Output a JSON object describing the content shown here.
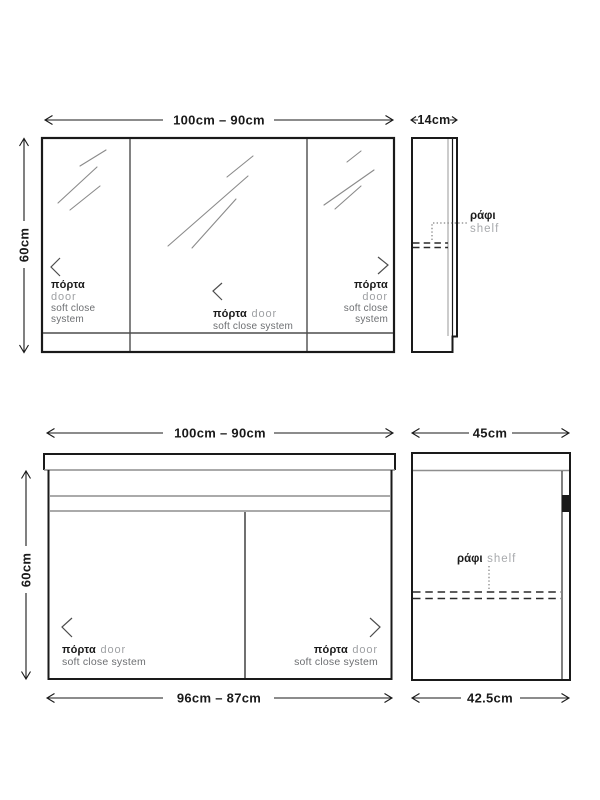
{
  "diagram": {
    "labels": {
      "porta": "πόρτα",
      "door": "door",
      "soft_close": "soft close",
      "system": "system",
      "soft_close_system": "soft close system",
      "rafi": "ράφι",
      "shelf": "shelf"
    },
    "mirror_cabinet": {
      "width_range": "100cm – 90cm",
      "depth": "14cm",
      "height": "60cm"
    },
    "vanity_cabinet": {
      "width_range": "100cm – 90cm",
      "depth": "45cm",
      "height": "60cm",
      "carcass_width_range": "96cm – 87cm",
      "carcass_depth": "42.5cm"
    },
    "colors": {
      "ink": "#1a1a1a",
      "divider_gray": "#4d4d4d",
      "light_line_gray": "#8e8e8e",
      "gray_text": "#9fa1a4",
      "dark_gray_text": "#6d6f72"
    }
  }
}
